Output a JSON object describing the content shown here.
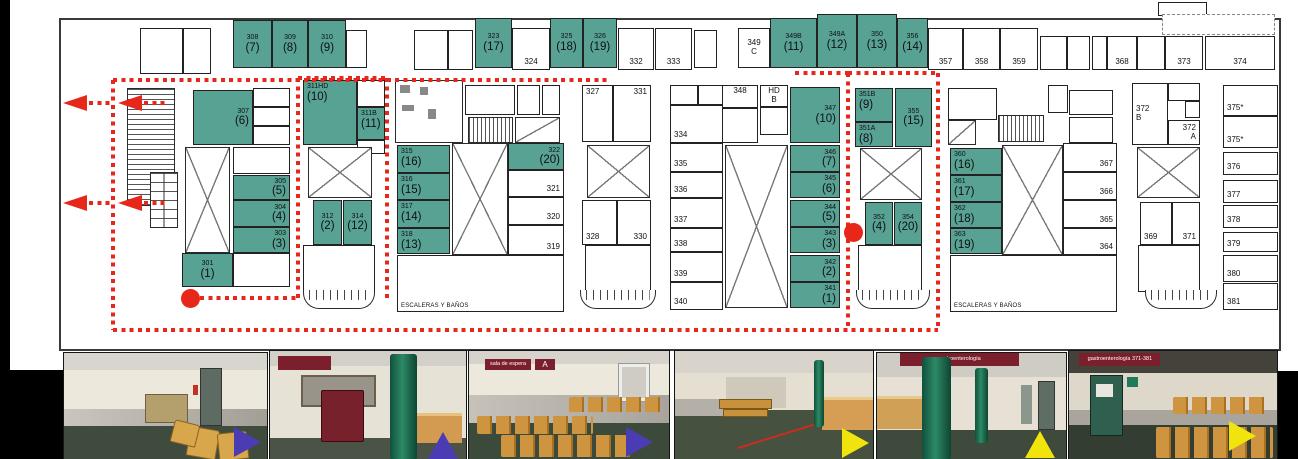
{
  "colors": {
    "highlight_green": "#58a294",
    "route_red": "#e8271b",
    "marker_blue": "#4c3cb4",
    "marker_yellow": "#f0e40c",
    "sign_maroon": "#7c1f2c"
  },
  "plan": {
    "escaleras_label": "ESCALERAS Y BAÑOS",
    "rooms": [
      {
        "x": 140,
        "y": 28,
        "w": 43,
        "h": 46
      },
      {
        "x": 183,
        "y": 28,
        "w": 28,
        "h": 46
      },
      {
        "l": "308",
        "s": "(7)",
        "f": "g",
        "x": 233,
        "y": 20,
        "w": 39,
        "h": 48
      },
      {
        "l": "309",
        "s": "(8)",
        "f": "g",
        "x": 272,
        "y": 20,
        "w": 36,
        "h": 48
      },
      {
        "l": "310",
        "s": "(9)",
        "f": "g",
        "x": 308,
        "y": 20,
        "w": 38,
        "h": 48
      },
      {
        "x": 346,
        "y": 30,
        "w": 21,
        "h": 38
      },
      {
        "x": 414,
        "y": 30,
        "w": 34,
        "h": 40
      },
      {
        "x": 448,
        "y": 30,
        "w": 25,
        "h": 40
      },
      {
        "l": "323",
        "s": "(17)",
        "f": "g",
        "x": 475,
        "y": 18,
        "w": 37,
        "h": 50
      },
      {
        "l": "324",
        "p": "bc",
        "x": 512,
        "y": 28,
        "w": 38,
        "h": 42
      },
      {
        "l": "325",
        "s": "(18)",
        "f": "g",
        "x": 550,
        "y": 18,
        "w": 33,
        "h": 50
      },
      {
        "l": "326",
        "s": "(19)",
        "f": "g",
        "x": 583,
        "y": 18,
        "w": 34,
        "h": 50
      },
      {
        "l": "332",
        "p": "bc",
        "x": 618,
        "y": 28,
        "w": 36,
        "h": 42
      },
      {
        "l": "333",
        "p": "bc",
        "x": 655,
        "y": 28,
        "w": 37,
        "h": 42
      },
      {
        "x": 694,
        "y": 30,
        "w": 23,
        "h": 38
      },
      {
        "l": "349",
        "s": "C",
        "p": "c",
        "x": 738,
        "y": 28,
        "w": 32,
        "h": 40
      },
      {
        "l": "349B",
        "s": "(11)",
        "f": "g",
        "x": 770,
        "y": 18,
        "w": 47,
        "h": 50
      },
      {
        "l": "349A",
        "s": "(12)",
        "f": "g",
        "x": 817,
        "y": 14,
        "w": 40,
        "h": 54
      },
      {
        "l": "350",
        "s": "(13)",
        "f": "g",
        "x": 857,
        "y": 14,
        "w": 40,
        "h": 54
      },
      {
        "l": "356",
        "s": "(14)",
        "f": "g",
        "x": 897,
        "y": 18,
        "w": 31,
        "h": 50
      },
      {
        "l": "357",
        "p": "bc",
        "x": 928,
        "y": 28,
        "w": 35,
        "h": 42
      },
      {
        "l": "358",
        "p": "bc",
        "x": 963,
        "y": 28,
        "w": 37,
        "h": 42
      },
      {
        "l": "359",
        "p": "bc",
        "x": 1000,
        "y": 28,
        "w": 38,
        "h": 42
      },
      {
        "x": 1040,
        "y": 36,
        "w": 27,
        "h": 34
      },
      {
        "x": 1067,
        "y": 36,
        "w": 23,
        "h": 34
      },
      {
        "x": 1092,
        "y": 36,
        "w": 15,
        "h": 34
      },
      {
        "l": "368",
        "p": "bc",
        "x": 1107,
        "y": 36,
        "w": 30,
        "h": 34
      },
      {
        "x": 1137,
        "y": 36,
        "w": 28,
        "h": 34
      },
      {
        "l": "373",
        "p": "bc",
        "x": 1165,
        "y": 36,
        "w": 38,
        "h": 34
      },
      {
        "x": 1158,
        "y": 2,
        "w": 49,
        "h": 14
      },
      {
        "d": 1,
        "x": 1162,
        "y": 14,
        "w": 113,
        "h": 21
      },
      {
        "l": "374",
        "p": "bc",
        "x": 1205,
        "y": 36,
        "w": 70,
        "h": 34
      },
      {
        "l": "307",
        "s": "(6)",
        "f": "g",
        "p": "r",
        "x": 193,
        "y": 90,
        "w": 60,
        "h": 55
      },
      {
        "x": 253,
        "y": 88,
        "w": 37,
        "h": 19
      },
      {
        "x": 253,
        "y": 107,
        "w": 37,
        "h": 19
      },
      {
        "x": 253,
        "y": 126,
        "w": 37,
        "h": 19
      },
      {
        "x": 233,
        "y": 147,
        "w": 57,
        "h": 27
      },
      {
        "l": "305",
        "s": "(5)",
        "f": "g",
        "p": "r",
        "x": 233,
        "y": 175,
        "w": 57,
        "h": 25
      },
      {
        "l": "304",
        "s": "(4)",
        "f": "g",
        "p": "r",
        "x": 233,
        "y": 200,
        "w": 57,
        "h": 27
      },
      {
        "l": "303",
        "s": "(3)",
        "f": "g",
        "p": "r",
        "x": 233,
        "y": 227,
        "w": 57,
        "h": 26
      },
      {
        "l": "301",
        "s": "(1)",
        "f": "g",
        "x": 182,
        "y": 253,
        "w": 51,
        "h": 34
      },
      {
        "x": 233,
        "y": 253,
        "w": 57,
        "h": 34
      },
      {
        "l": "311HD",
        "s": "(10)",
        "f": "g",
        "p": "tl",
        "x": 303,
        "y": 80,
        "w": 54,
        "h": 65
      },
      {
        "x": 357,
        "y": 80,
        "w": 28,
        "h": 27
      },
      {
        "l": "311B",
        "s": "(11)",
        "f": "g",
        "p": "tl",
        "x": 357,
        "y": 107,
        "w": 28,
        "h": 33
      },
      {
        "x": 357,
        "y": 140,
        "w": 28,
        "h": 14
      },
      {
        "l": "312",
        "s": "(2)",
        "f": "g",
        "x": 313,
        "y": 200,
        "w": 29,
        "h": 45
      },
      {
        "l": "314",
        "s": "(12)",
        "f": "g",
        "x": 343,
        "y": 200,
        "w": 29,
        "h": 45
      },
      {
        "x": 303,
        "y": 245,
        "w": 72,
        "h": 47
      },
      {
        "x": 465,
        "y": 85,
        "w": 50,
        "h": 30
      },
      {
        "x": 517,
        "y": 85,
        "w": 23,
        "h": 30
      },
      {
        "x": 542,
        "y": 85,
        "w": 18,
        "h": 30
      },
      {
        "l": "315",
        "s": "(16)",
        "f": "g",
        "p": "tl",
        "x": 397,
        "y": 145,
        "w": 53,
        "h": 28
      },
      {
        "l": "316",
        "s": "(15)",
        "f": "g",
        "p": "tl",
        "x": 397,
        "y": 173,
        "w": 53,
        "h": 27
      },
      {
        "l": "317",
        "s": "(14)",
        "f": "g",
        "p": "tl",
        "x": 397,
        "y": 200,
        "w": 53,
        "h": 28
      },
      {
        "l": "318",
        "s": "(13)",
        "f": "g",
        "p": "tl",
        "x": 397,
        "y": 228,
        "w": 53,
        "h": 26
      },
      {
        "l": "322",
        "s": "(20)",
        "f": "g",
        "p": "r",
        "x": 508,
        "y": 143,
        "w": 56,
        "h": 27
      },
      {
        "l": "321",
        "p": "br",
        "x": 508,
        "y": 170,
        "w": 56,
        "h": 27
      },
      {
        "l": "320",
        "p": "br",
        "x": 508,
        "y": 197,
        "w": 56,
        "h": 28
      },
      {
        "l": "319",
        "p": "br",
        "x": 508,
        "y": 225,
        "w": 56,
        "h": 30
      },
      {
        "l": "ESCALERAS Y BAÑOS",
        "p": "bl",
        "sm": 1,
        "x": 397,
        "y": 255,
        "w": 167,
        "h": 57
      },
      {
        "l": "327",
        "p": "tl",
        "x": 582,
        "y": 85,
        "w": 31,
        "h": 57
      },
      {
        "l": "331",
        "p": "tr",
        "x": 613,
        "y": 85,
        "w": 38,
        "h": 57
      },
      {
        "l": "328",
        "p": "bl",
        "x": 582,
        "y": 200,
        "w": 35,
        "h": 45
      },
      {
        "l": "330",
        "p": "br",
        "x": 617,
        "y": 200,
        "w": 34,
        "h": 45
      },
      {
        "x": 585,
        "y": 245,
        "w": 66,
        "h": 47
      },
      {
        "x": 670,
        "y": 85,
        "w": 28,
        "h": 20
      },
      {
        "x": 698,
        "y": 85,
        "w": 25,
        "h": 20
      },
      {
        "l": "334",
        "p": "bl",
        "x": 670,
        "y": 105,
        "w": 53,
        "h": 38
      },
      {
        "l": "335",
        "p": "bl",
        "x": 670,
        "y": 143,
        "w": 53,
        "h": 29
      },
      {
        "l": "336",
        "p": "bl",
        "x": 670,
        "y": 172,
        "w": 53,
        "h": 26
      },
      {
        "l": "337",
        "p": "bl",
        "x": 670,
        "y": 198,
        "w": 53,
        "h": 30
      },
      {
        "l": "338",
        "p": "bl",
        "x": 670,
        "y": 228,
        "w": 53,
        "h": 24
      },
      {
        "l": "339",
        "p": "bl",
        "x": 670,
        "y": 252,
        "w": 53,
        "h": 30
      },
      {
        "l": "340",
        "p": "bl",
        "x": 670,
        "y": 282,
        "w": 53,
        "h": 28
      },
      {
        "l": "348",
        "p": "tc",
        "x": 722,
        "y": 85,
        "w": 36,
        "h": 23
      },
      {
        "l": "HD",
        "s": "B",
        "p": "tc",
        "x": 760,
        "y": 85,
        "w": 28,
        "h": 22
      },
      {
        "x": 760,
        "y": 107,
        "w": 28,
        "h": 28
      },
      {
        "x": 722,
        "y": 108,
        "w": 36,
        "h": 35
      },
      {
        "l": "347",
        "s": "(10)",
        "f": "g",
        "p": "r",
        "x": 790,
        "y": 87,
        "w": 50,
        "h": 56
      },
      {
        "l": "346",
        "s": "(7)",
        "f": "g",
        "p": "r",
        "x": 790,
        "y": 145,
        "w": 50,
        "h": 27
      },
      {
        "l": "345",
        "s": "(6)",
        "f": "g",
        "p": "r",
        "x": 790,
        "y": 172,
        "w": 50,
        "h": 26
      },
      {
        "l": "344",
        "s": "(5)",
        "f": "g",
        "p": "r",
        "x": 790,
        "y": 200,
        "w": 50,
        "h": 27
      },
      {
        "l": "343",
        "s": "(3)",
        "f": "g",
        "p": "r",
        "x": 790,
        "y": 227,
        "w": 50,
        "h": 26
      },
      {
        "l": "342",
        "s": "(2)",
        "f": "g",
        "p": "r",
        "x": 790,
        "y": 255,
        "w": 50,
        "h": 27
      },
      {
        "l": "341",
        "s": "(1)",
        "f": "g",
        "p": "r",
        "x": 790,
        "y": 282,
        "w": 50,
        "h": 26
      },
      {
        "l": "351B",
        "s": "(9)",
        "f": "g",
        "p": "tl",
        "x": 855,
        "y": 88,
        "w": 38,
        "h": 34
      },
      {
        "l": "355",
        "s": "(15)",
        "f": "g",
        "x": 895,
        "y": 88,
        "w": 37,
        "h": 59
      },
      {
        "l": "351A",
        "s": "(8)",
        "f": "g",
        "p": "tl",
        "x": 855,
        "y": 122,
        "w": 38,
        "h": 25
      },
      {
        "l": "352",
        "s": "(4)",
        "f": "g",
        "x": 865,
        "y": 202,
        "w": 28,
        "h": 43
      },
      {
        "l": "354",
        "s": "(20)",
        "f": "g",
        "x": 894,
        "y": 202,
        "w": 28,
        "h": 43
      },
      {
        "x": 858,
        "y": 245,
        "w": 64,
        "h": 47
      },
      {
        "x": 948,
        "y": 88,
        "w": 49,
        "h": 32
      },
      {
        "x": 1048,
        "y": 85,
        "w": 20,
        "h": 28
      },
      {
        "x": 1069,
        "y": 90,
        "w": 44,
        "h": 25
      },
      {
        "x": 1069,
        "y": 117,
        "w": 44,
        "h": 26
      },
      {
        "l": "360",
        "s": "(16)",
        "f": "g",
        "p": "tl",
        "x": 950,
        "y": 148,
        "w": 52,
        "h": 27
      },
      {
        "l": "361",
        "s": "(17)",
        "f": "g",
        "p": "tl",
        "x": 950,
        "y": 175,
        "w": 52,
        "h": 27
      },
      {
        "l": "362",
        "s": "(18)",
        "f": "g",
        "p": "tl",
        "x": 950,
        "y": 202,
        "w": 52,
        "h": 26
      },
      {
        "l": "363",
        "s": "(19)",
        "f": "g",
        "p": "tl",
        "x": 950,
        "y": 228,
        "w": 52,
        "h": 26
      },
      {
        "l": "367",
        "p": "br",
        "x": 1063,
        "y": 143,
        "w": 54,
        "h": 29
      },
      {
        "l": "366",
        "p": "br",
        "x": 1063,
        "y": 172,
        "w": 54,
        "h": 28
      },
      {
        "l": "365",
        "p": "br",
        "x": 1063,
        "y": 200,
        "w": 54,
        "h": 28
      },
      {
        "l": "364",
        "p": "br",
        "x": 1063,
        "y": 228,
        "w": 54,
        "h": 27
      },
      {
        "l": "ESCALERAS Y BAÑOS",
        "p": "bl",
        "sm": 1,
        "x": 950,
        "y": 255,
        "w": 167,
        "h": 57
      },
      {
        "l": "372",
        "s": "B",
        "p": "l",
        "x": 1132,
        "y": 83,
        "w": 36,
        "h": 62
      },
      {
        "x": 1168,
        "y": 83,
        "w": 32,
        "h": 18
      },
      {
        "x": 1185,
        "y": 101,
        "w": 15,
        "h": 17
      },
      {
        "l": "372",
        "s": "A",
        "p": "r",
        "x": 1168,
        "y": 120,
        "w": 32,
        "h": 25
      },
      {
        "l": "369",
        "p": "bl",
        "x": 1140,
        "y": 202,
        "w": 32,
        "h": 43
      },
      {
        "l": "371",
        "p": "br",
        "x": 1172,
        "y": 202,
        "w": 28,
        "h": 43
      },
      {
        "x": 1138,
        "y": 245,
        "w": 62,
        "h": 47
      },
      {
        "l": "375*",
        "p": "bl",
        "x": 1223,
        "y": 85,
        "w": 55,
        "h": 31
      },
      {
        "l": "375*",
        "p": "bl",
        "x": 1223,
        "y": 116,
        "w": 55,
        "h": 32
      },
      {
        "l": "376",
        "p": "bl",
        "x": 1223,
        "y": 152,
        "w": 55,
        "h": 23
      },
      {
        "l": "377",
        "p": "bl",
        "x": 1223,
        "y": 180,
        "w": 55,
        "h": 23
      },
      {
        "l": "378",
        "p": "bl",
        "x": 1223,
        "y": 205,
        "w": 55,
        "h": 23
      },
      {
        "l": "379",
        "p": "bl",
        "x": 1223,
        "y": 232,
        "w": 55,
        "h": 20
      },
      {
        "l": "380",
        "p": "bl",
        "x": 1223,
        "y": 255,
        "w": 55,
        "h": 27
      },
      {
        "l": "381",
        "p": "bl",
        "x": 1223,
        "y": 283,
        "w": 55,
        "h": 27
      }
    ],
    "features": [
      {
        "t": "stairs",
        "x": 127,
        "y": 88,
        "w": 48,
        "h": 118
      },
      {
        "t": "elev",
        "x": 150,
        "y": 172,
        "w": 28,
        "h": 56
      },
      {
        "t": "x",
        "x": 185,
        "y": 147,
        "w": 45,
        "h": 106
      },
      {
        "t": "x",
        "x": 308,
        "y": 147,
        "w": 64,
        "h": 51
      },
      {
        "t": "bay",
        "x": 303,
        "y": 290,
        "w": 72,
        "h": 19
      },
      {
        "t": "equip",
        "x": 395,
        "y": 80,
        "w": 68,
        "h": 63
      },
      {
        "t": "stairs2",
        "x": 468,
        "y": 117,
        "w": 45,
        "h": 26
      },
      {
        "t": "diag",
        "x": 515,
        "y": 117,
        "w": 45,
        "h": 26
      },
      {
        "t": "x",
        "x": 452,
        "y": 143,
        "w": 56,
        "h": 112
      },
      {
        "t": "x",
        "x": 587,
        "y": 145,
        "w": 63,
        "h": 53
      },
      {
        "t": "bay",
        "x": 580,
        "y": 290,
        "w": 76,
        "h": 19
      },
      {
        "t": "x",
        "x": 725,
        "y": 145,
        "w": 63,
        "h": 163
      },
      {
        "t": "x",
        "x": 860,
        "y": 148,
        "w": 62,
        "h": 52
      },
      {
        "t": "bay",
        "x": 856,
        "y": 290,
        "w": 74,
        "h": 19
      },
      {
        "t": "diag",
        "x": 948,
        "y": 120,
        "w": 28,
        "h": 25
      },
      {
        "t": "stairs2",
        "x": 998,
        "y": 115,
        "w": 46,
        "h": 27
      },
      {
        "t": "x",
        "x": 1002,
        "y": 145,
        "w": 61,
        "h": 110
      },
      {
        "t": "x",
        "x": 1137,
        "y": 147,
        "w": 63,
        "h": 51
      },
      {
        "t": "bay",
        "x": 1145,
        "y": 290,
        "w": 72,
        "h": 19
      }
    ],
    "route": {
      "segments": [
        {
          "x1": 113,
          "y1": 80,
          "x2": 610,
          "y2": 80
        },
        {
          "x1": 795,
          "y1": 73,
          "x2": 848,
          "y2": 73
        },
        {
          "x1": 113,
          "y1": 80,
          "x2": 113,
          "y2": 330
        },
        {
          "x1": 113,
          "y1": 330,
          "x2": 938,
          "y2": 330
        },
        {
          "x1": 298,
          "y1": 78,
          "x2": 387,
          "y2": 78
        },
        {
          "x1": 298,
          "y1": 78,
          "x2": 298,
          "y2": 300
        },
        {
          "x1": 387,
          "y1": 78,
          "x2": 387,
          "y2": 300
        },
        {
          "x1": 848,
          "y1": 73,
          "x2": 938,
          "y2": 73
        },
        {
          "x1": 848,
          "y1": 73,
          "x2": 848,
          "y2": 330
        },
        {
          "x1": 938,
          "y1": 73,
          "x2": 938,
          "y2": 330
        },
        {
          "x1": 200,
          "y1": 298,
          "x2": 297,
          "y2": 298
        }
      ],
      "arrows": [
        {
          "x": 63,
          "y": 103
        },
        {
          "x": 118,
          "y": 103
        },
        {
          "x": 63,
          "y": 203
        },
        {
          "x": 118,
          "y": 203
        }
      ],
      "dots": [
        {
          "x": 190,
          "y": 298
        },
        {
          "x": 853,
          "y": 232
        }
      ]
    }
  },
  "photos": [
    {
      "marker": "marker indigo right"
    },
    {
      "marker": "marker indigo up",
      "sign": ""
    },
    {
      "marker": "marker indigo right",
      "sign": "sala de espera",
      "letter": "A"
    },
    {
      "marker": "marker yellow right"
    },
    {
      "marker": "marker yellow up",
      "sign": "gastroenterología"
    },
    {
      "marker": "marker yellow right",
      "sign": "gastroenterología 371-381"
    }
  ]
}
